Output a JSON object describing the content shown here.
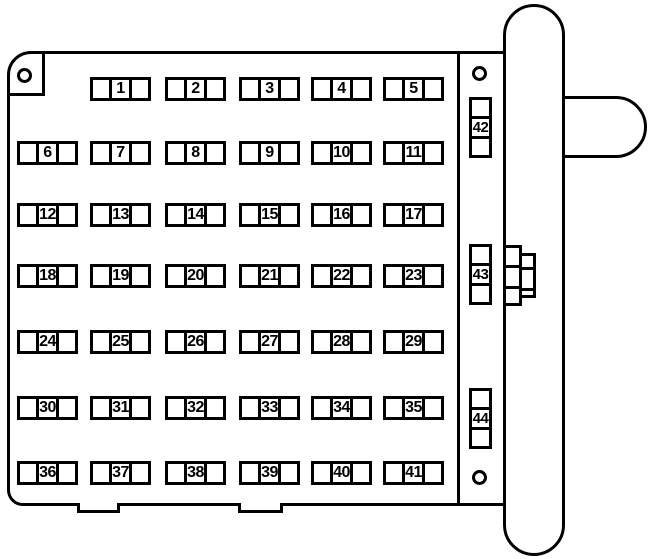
{
  "diagram": {
    "type": "fuse-box",
    "background_color": "#ffffff",
    "line_color": "#000000",
    "horizontal_fuse_rows": [
      {
        "fuses": [
          "1",
          "2",
          "3",
          "4",
          "5"
        ]
      },
      {
        "fuses": [
          "6",
          "7",
          "8",
          "9",
          "10",
          "11"
        ]
      },
      {
        "fuses": [
          "12",
          "13",
          "14",
          "15",
          "16",
          "17"
        ]
      },
      {
        "fuses": [
          "18",
          "19",
          "20",
          "21",
          "22",
          "23"
        ]
      },
      {
        "fuses": [
          "24",
          "25",
          "26",
          "27",
          "28",
          "29"
        ]
      },
      {
        "fuses": [
          "30",
          "31",
          "32",
          "33",
          "34",
          "35"
        ]
      },
      {
        "fuses": [
          "36",
          "37",
          "38",
          "39",
          "40",
          "41"
        ]
      }
    ],
    "vertical_fuses": [
      "42",
      "43",
      "44"
    ],
    "screw_holes_count": 3,
    "mounting_tabs_count": 2
  }
}
